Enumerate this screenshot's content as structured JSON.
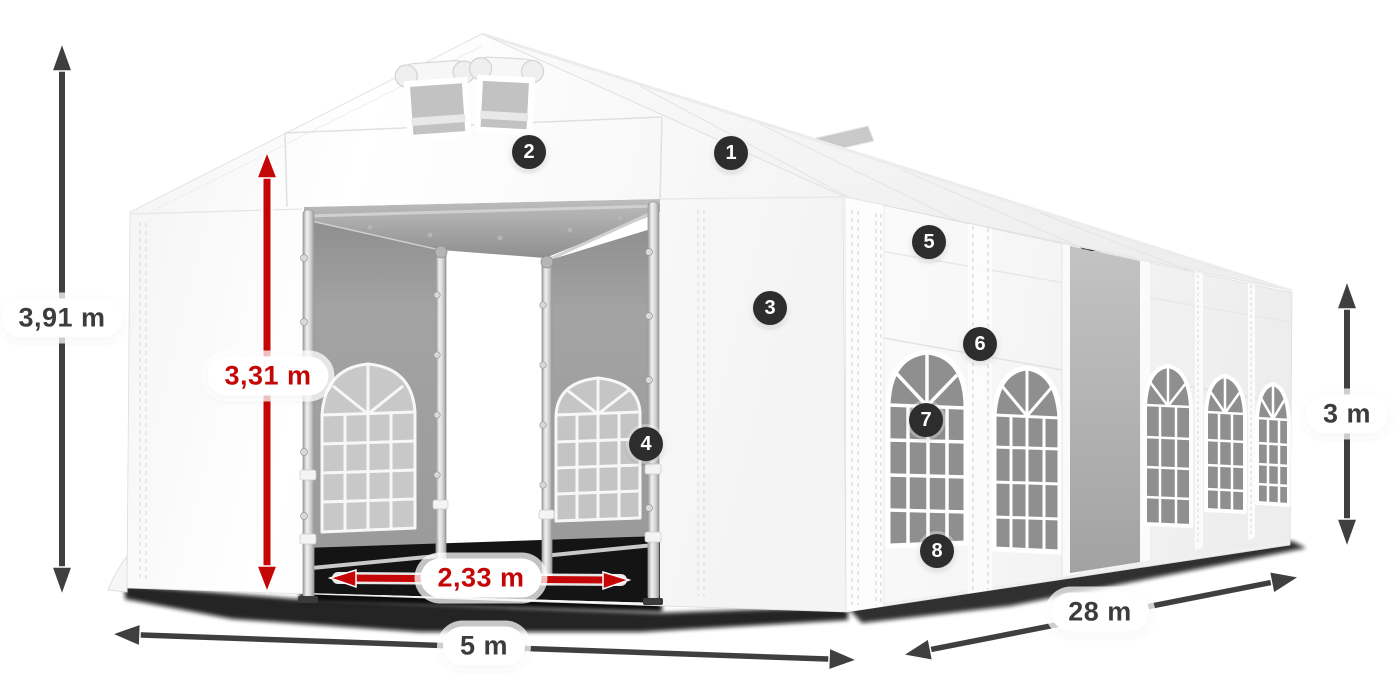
{
  "dimension_labels": {
    "total_height": "3,91 m",
    "entrance_height": "3,31 m",
    "entrance_width": "2,33 m",
    "front_width": "5 m",
    "side_length": "28 m",
    "wall_height": "3 m"
  },
  "feature_markers": [
    {
      "number": "1"
    },
    {
      "number": "2"
    },
    {
      "number": "3"
    },
    {
      "number": "4"
    },
    {
      "number": "5"
    },
    {
      "number": "6"
    },
    {
      "number": "7"
    },
    {
      "number": "8"
    }
  ],
  "colors": {
    "dimension_arrow_dark": "#3f3f3f",
    "dimension_arrow_red": "#c40606",
    "dimension_text_dark": "#3c3c3c",
    "dimension_text_red": "#c40606",
    "marker_background": "#2d2d2d",
    "marker_text": "#ffffff",
    "tent_white": "#f7f7f7",
    "interior_gray": "#9c9c9c"
  }
}
